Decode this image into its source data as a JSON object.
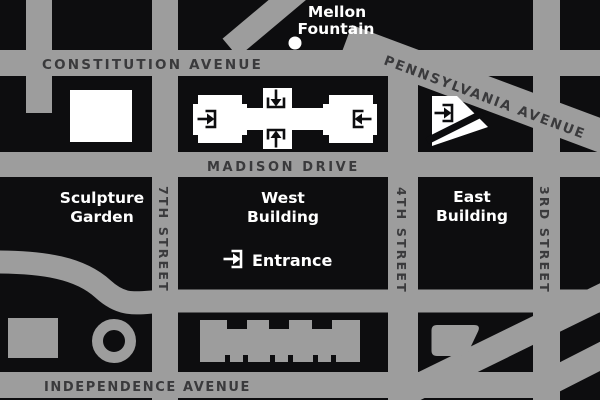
{
  "colors": {
    "street_gray": "#9d9d9d",
    "block_black": "#0d0d0f",
    "street_label": "#3a3a3c",
    "landmark_label": "#ffffff"
  },
  "streets": {
    "constitution": "CONSTITUTION AVENUE",
    "pennsylvania": "PENNSYLVANIA AVENUE",
    "madison": "MADISON DRIVE",
    "independence": "INDEPENDENCE AVENUE",
    "seventh": "7TH STREET",
    "fourth": "4TH STREET",
    "third": "3RD STREET"
  },
  "landmarks": {
    "mellon_line1": "Mellon",
    "mellon_line2": "Fountain",
    "sculpture_line1": "Sculpture",
    "sculpture_line2": "Garden",
    "west_line1": "West",
    "west_line2": "Building",
    "east_line1": "East",
    "east_line2": "Building",
    "entrance": "Entrance"
  }
}
